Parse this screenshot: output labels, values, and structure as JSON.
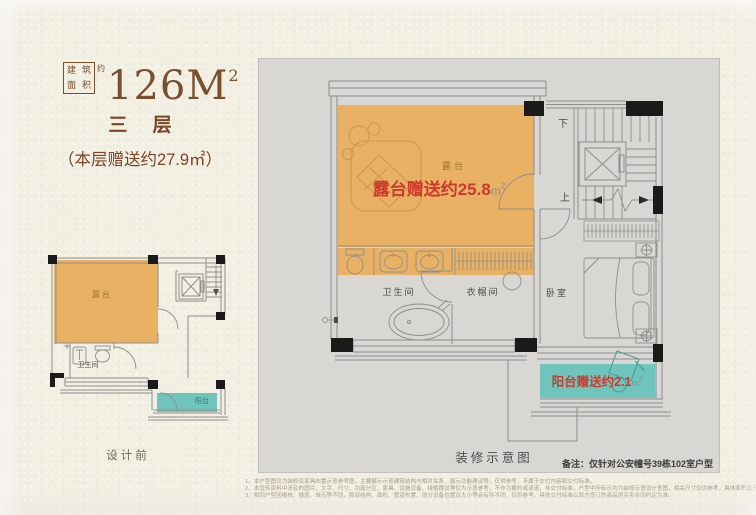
{
  "header": {
    "stamp": {
      "chars": [
        "建",
        "筑",
        "面",
        "积"
      ],
      "suffix": "约"
    },
    "area": {
      "value": "126M",
      "sup": "2"
    },
    "floor_title": "三 层",
    "floor_subtitle": "（本层赠送约27.9㎡）"
  },
  "small_plan": {
    "caption": "设计前",
    "labels": {
      "terrace": "露台",
      "bathroom": "卫生间",
      "balcony": "阳台"
    }
  },
  "main_plan": {
    "caption": "装修示意图",
    "note": "备注：仅针对公安幢号39栋102室户型",
    "labels": {
      "terrace": "露台",
      "bathroom": "卫生间",
      "cloakroom": "衣帽间",
      "bedroom": "卧室",
      "stairs_down": "下",
      "stairs_up": "上"
    },
    "annotations": {
      "terrace_gift": {
        "text": "露台赠送约25.8",
        "unit": "m",
        "unit_sup": "2"
      },
      "balcony_gift": {
        "text": "阳台赠送约2.1",
        "unit": "m",
        "unit_sup": "2"
      }
    }
  },
  "colors": {
    "page_cream": "#f1eee2",
    "canvas_gray": "#d8d7d4",
    "terrace_orange": "#e9b164",
    "balcony_teal": "#6fc5bb",
    "gift_red": "#cd392d",
    "title_brown": "#7a4f2e",
    "wall_gray": "#8f8e8b",
    "wall_black": "#1a1a1a"
  },
  "disclaimer": {
    "lines": [
      "1、本户型图仅为装修及家具布置示意参考图，主要展示示意建筑结构与相对关系、展示功能建议等，仅供参考，不属于交付内容和交付标准。",
      "2、本宣传资料中涉及的图片、文字、尺寸、功能分区、家具、设施设备、绿植摆设等仅为示意参考，不作为要约或承诺，非交付标准，户型中所标示均为装修示意设计意图，相关尺寸仅供参考，具体面积及尺寸以政府最终批准图纸及双方签订的商品房买卖合同约定及交付为准。",
      "3、相同户型因楼栋、楼层、单元等不同，局部结构、面积、管道布置、部分设备位置及大小等会有所不同，仅供参考，具体交付标准以双方签订的商品房买卖合同约定为准。"
    ]
  }
}
